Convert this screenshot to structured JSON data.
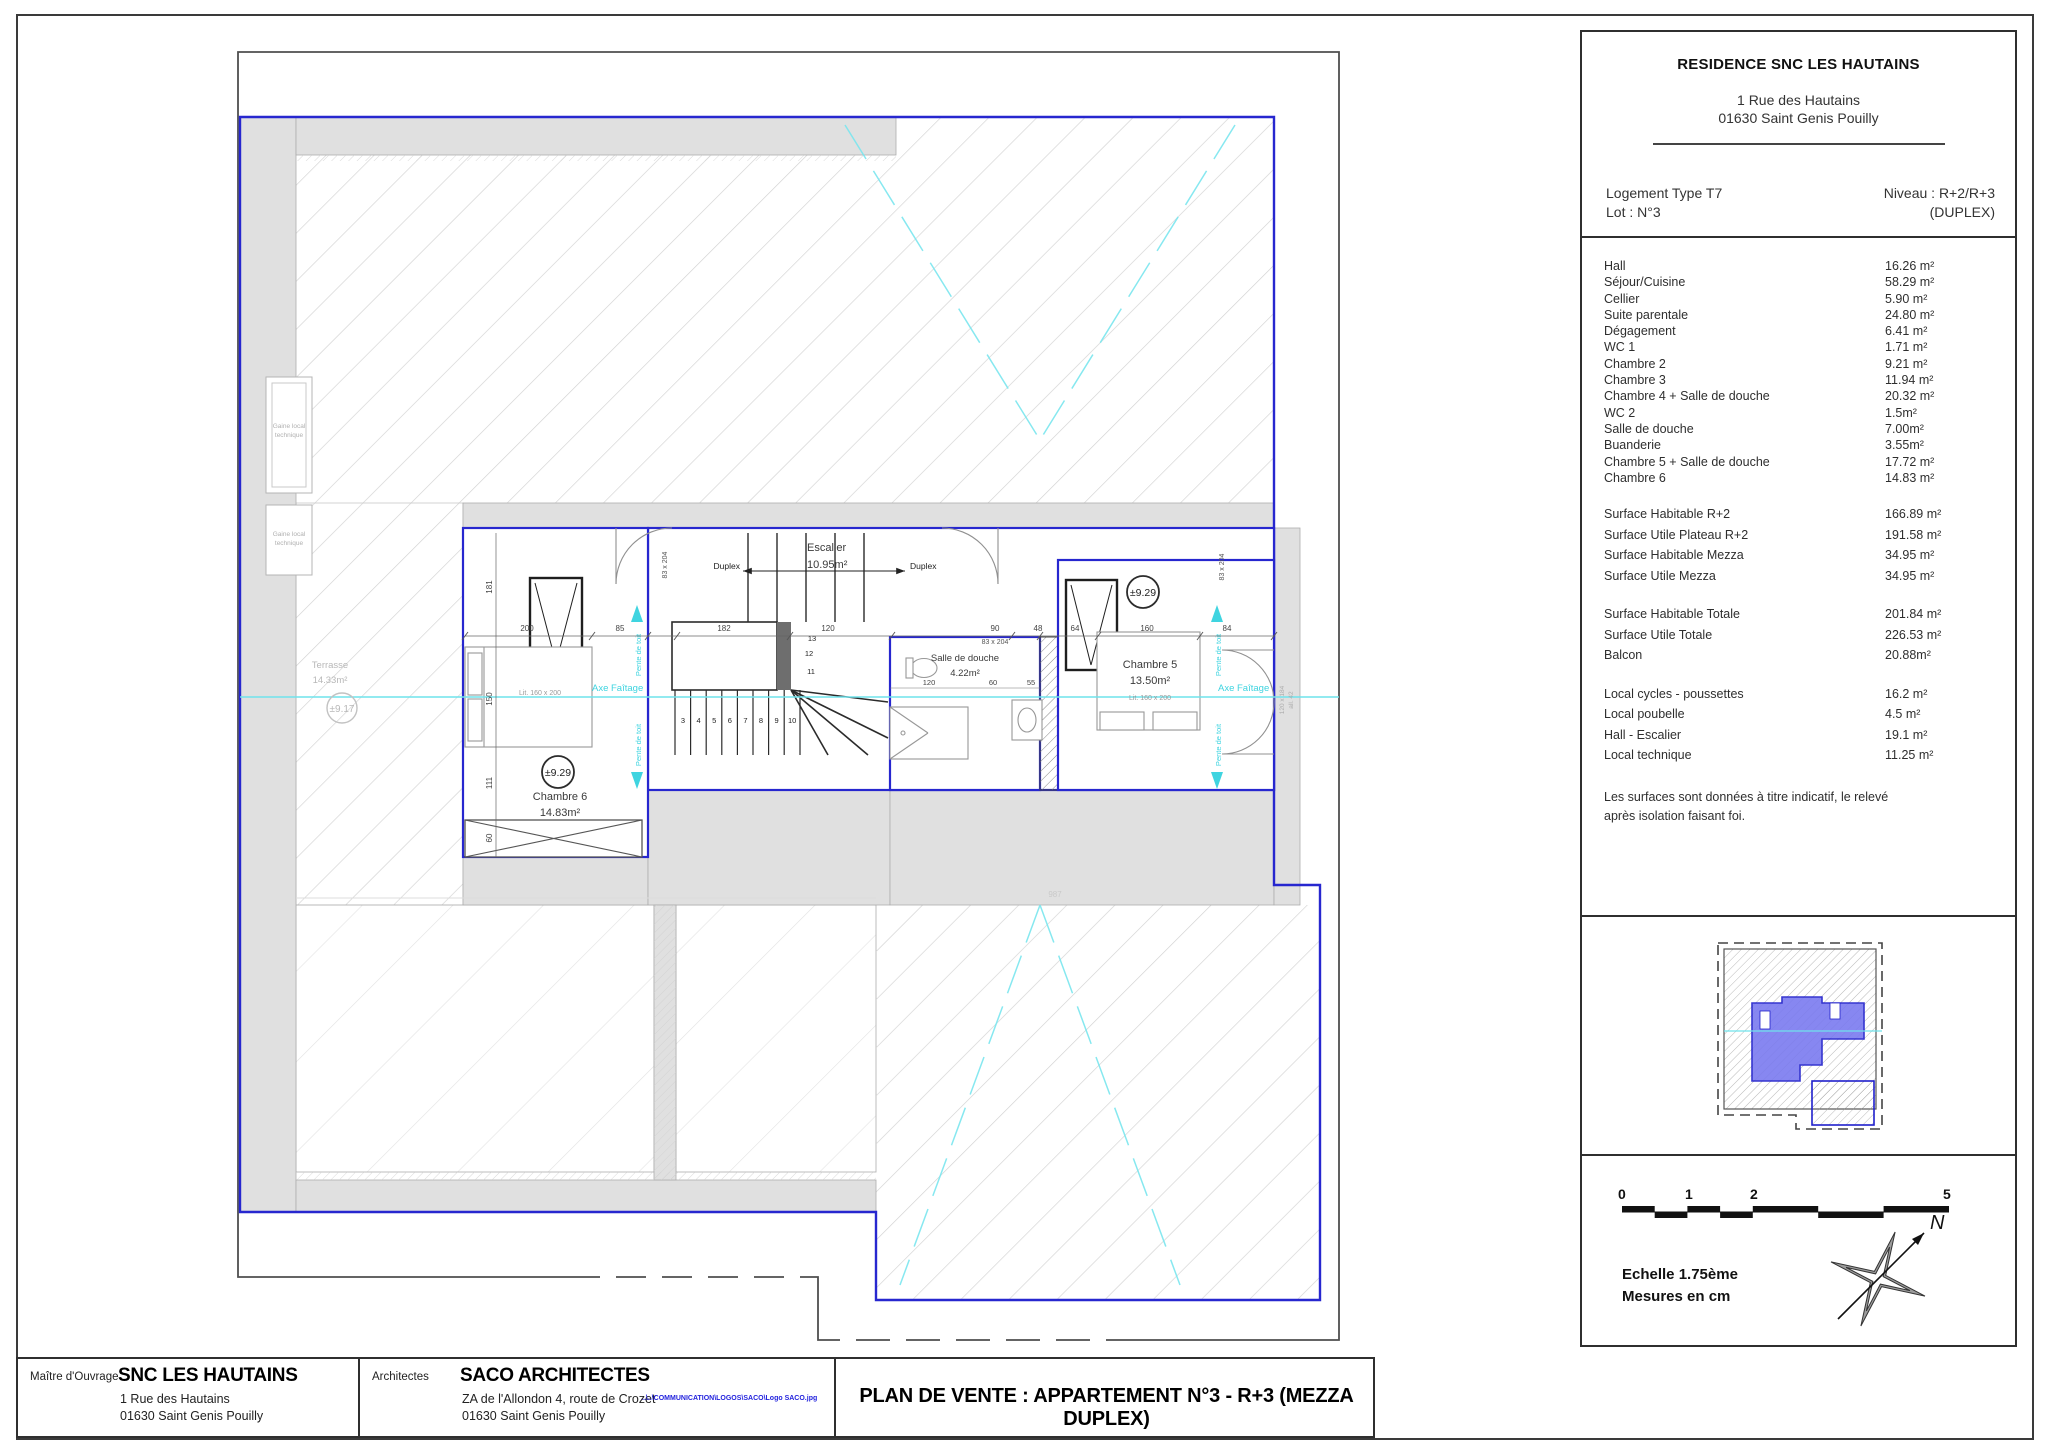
{
  "panel": {
    "title": "RESIDENCE SNC LES HAUTAINS",
    "address1": "1 Rue des Hautains",
    "address2": "01630 Saint Genis  Pouilly",
    "logement": "Logement Type T7",
    "lot": "Lot : N°3",
    "niveau": "Niveau : R+2/R+3",
    "niveau2": "(DUPLEX)",
    "rooms": [
      {
        "label": "Hall",
        "value": "16.26 m²"
      },
      {
        "label": "Séjour/Cuisine",
        "value": "58.29 m²"
      },
      {
        "label": "Cellier",
        "value": "5.90 m²"
      },
      {
        "label": "Suite parentale",
        "value": "24.80 m²"
      },
      {
        "label": "Dégagement",
        "value": "6.41 m²"
      },
      {
        "label": "WC 1",
        "value": "1.71 m²"
      },
      {
        "label": "Chambre 2",
        "value": "9.21 m²"
      },
      {
        "label": "Chambre 3",
        "value": "11.94 m²"
      },
      {
        "label": "Chambre 4 + Salle de douche",
        "value": "20.32 m²"
      },
      {
        "label": "WC 2",
        "value": "1.5m²"
      },
      {
        "label": "Salle de douche",
        "value": "7.00m²"
      },
      {
        "label": "Buanderie",
        "value": "3.55m²"
      },
      {
        "label": "Chambre 5 + Salle de douche",
        "value": "17.72 m²"
      },
      {
        "label": "Chambre 6",
        "value": "14.83 m²"
      }
    ],
    "surfaces": [
      {
        "label": "Surface Habitable R+2",
        "value": "166.89 m²"
      },
      {
        "label": "Surface Utile Plateau R+2",
        "value": "191.58 m²"
      },
      {
        "label": "Surface Habitable Mezza",
        "value": "34.95 m²"
      },
      {
        "label": "Surface Utile Mezza",
        "value": "34.95 m²"
      }
    ],
    "totals": [
      {
        "label": "Surface Habitable Totale",
        "value": "201.84 m²"
      },
      {
        "label": "Surface Utile Totale",
        "value": "226.53 m²"
      },
      {
        "label": "Balcon",
        "value": "20.88m²"
      }
    ],
    "locals": [
      {
        "label": "Local cycles - poussettes",
        "value": "16.2 m²"
      },
      {
        "label": "Local poubelle",
        "value": "4.5 m²"
      },
      {
        "label": "Hall - Escalier",
        "value": "19.1 m²"
      },
      {
        "label": "Local technique",
        "value": "11.25 m²"
      }
    ],
    "note1": "Les surfaces sont données à titre indicatif, le relevé",
    "note2": "après isolation faisant foi."
  },
  "scalebox": {
    "t0": "0",
    "t1": "1",
    "t2": "2",
    "t5": "5",
    "echelle": "Echelle 1.75ème",
    "mesures": "Mesures en cm",
    "north": "N"
  },
  "titleblock": {
    "maitre_label": "Maître d'Ouvrage",
    "maitre_name": "SNC LES HAUTAINS",
    "maitre_addr1": "1 Rue des Hautains",
    "maitre_addr2": "01630 Saint Genis Pouilly",
    "arch_label": "Architectes",
    "arch_name": "SACO ARCHITECTES",
    "arch_addr1": "ZA de l'Allondon 4, route de Crozet",
    "arch_addr2": "01630 Saint Genis Pouilly",
    "logo_path": "..\\..\\COMMUNICATION\\LOGOS\\SACO\\Logo  SACO.jpg",
    "title": "PLAN DE VENTE : APPARTEMENT N°3 - R+3 (MEZZA DUPLEX)"
  },
  "plan": {
    "escalier_name": "Escalier",
    "escalier_area": "10.95m²",
    "sdd_name": "Salle de douche",
    "sdd_area": "4.22m²",
    "ch5_name": "Chambre 5",
    "ch5_area": "13.50m²",
    "ch5_bed": "Lit. 160 x 200",
    "ch6_name": "Chambre 6",
    "ch6_area": "14.83m²",
    "ch6_bed": "Lit. 160 x 200",
    "terrasse_name": "Terrasse",
    "terrasse_area": "14.33m²",
    "level_up": "±9.29",
    "level_terrace": "±9.17",
    "duplex": "Duplex",
    "axe": "Axe Faîtage",
    "pente": "Pente de toit",
    "gaine1": "Gaine local",
    "gaine2": "technique",
    "door_dim": "83 x 204",
    "window_dim": "120 x 184",
    "window_allege": "all. 42",
    "ghost_dim": "987",
    "dims_top": [
      "200",
      "85",
      "182",
      "120",
      "90",
      "48",
      "64",
      "160",
      "84"
    ],
    "dims_left": [
      "181",
      "150",
      "111",
      "60"
    ],
    "dims_sdd": [
      "120",
      "60",
      "55"
    ],
    "stairs": [
      "3",
      "4",
      "5",
      "6",
      "7",
      "8",
      "9",
      "10"
    ],
    "winders": [
      "11",
      "12",
      "13"
    ]
  }
}
